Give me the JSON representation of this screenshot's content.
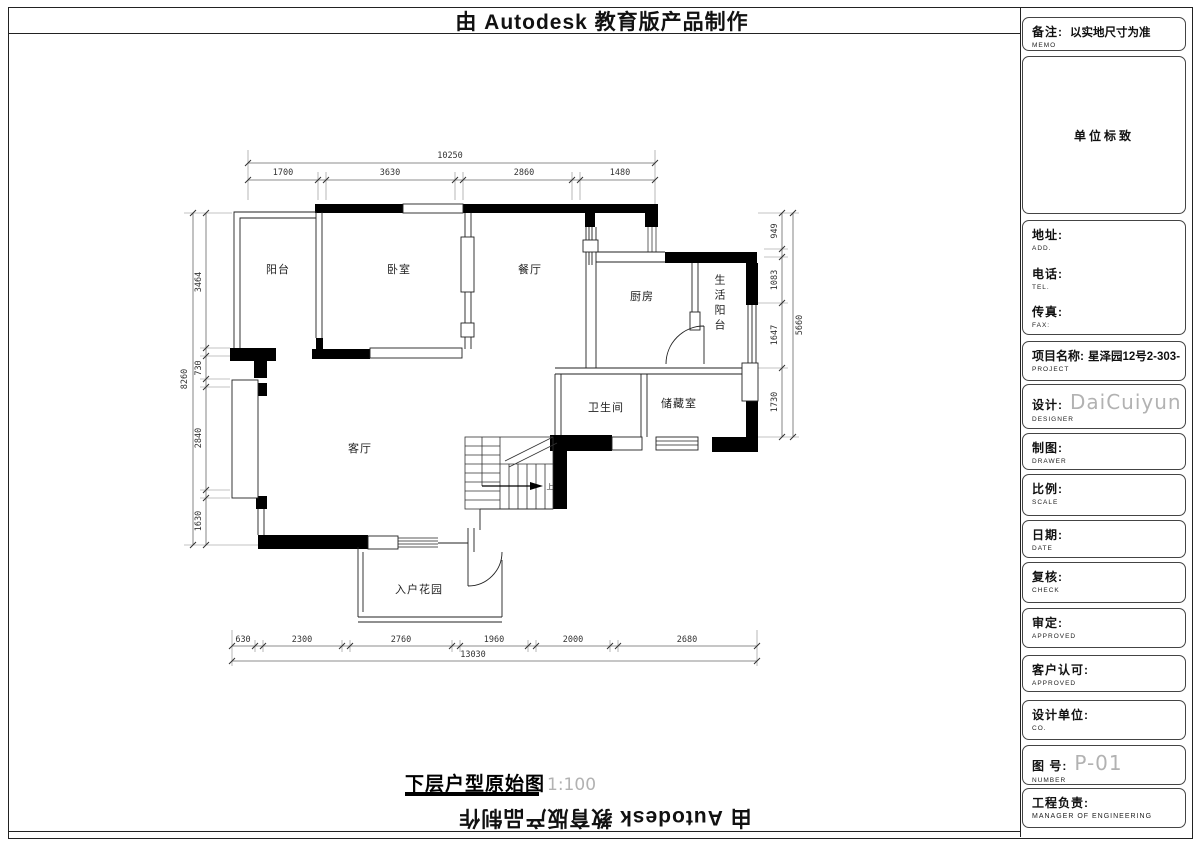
{
  "banner": {
    "text": "由 Autodesk 教育版产品制作"
  },
  "sheet_title": {
    "name": "下层户型原始图",
    "scale": "1:100"
  },
  "plan": {
    "rooms": [
      "阳台",
      "卧室",
      "餐厅",
      "厨房",
      "生活阳台",
      "卫生间",
      "储藏室",
      "客厅",
      "入户花园"
    ],
    "stair_direction": "上",
    "dims": {
      "top": {
        "overall": "10250",
        "segments": [
          "1700",
          "3630",
          "2860",
          "1480"
        ]
      },
      "bottom": {
        "overall": "13030",
        "segments": [
          "630",
          "2300",
          "2760",
          "1960",
          "2000",
          "2680"
        ]
      },
      "left": {
        "overall": "8260",
        "segments": [
          "3464",
          "730",
          "2840",
          "1630"
        ]
      },
      "right": {
        "overall": "5660",
        "segments": [
          "949",
          "1083",
          "1647",
          "1730"
        ]
      }
    }
  },
  "titleblock": {
    "memo": {
      "zh": "备注:",
      "en": "MEMO",
      "value": "以实地尺寸为准"
    },
    "logo": {
      "value": "单位标致"
    },
    "contact": {
      "address": {
        "zh": "地址:",
        "en": "ADD."
      },
      "phone": {
        "zh": "电话:",
        "en": "TEL."
      },
      "fax": {
        "zh": "传真:",
        "en": "FAX:"
      }
    },
    "project": {
      "zh": "项目名称:",
      "en": "PROJECT",
      "value": "星泽园12号2-303-"
    },
    "designer": {
      "zh": "设计:",
      "en": "DESIGNER",
      "value": "DaiCuiyun"
    },
    "drawer": {
      "zh": "制图:",
      "en": "DRAWER"
    },
    "scale": {
      "zh": "比例:",
      "en": "SCALE"
    },
    "date": {
      "zh": "日期:",
      "en": "DATE"
    },
    "check": {
      "zh": "复核:",
      "en": "CHECK"
    },
    "approved": {
      "zh": "审定:",
      "en": "APPROVED"
    },
    "client": {
      "zh": "客户认可:",
      "en": "APPROVED"
    },
    "company": {
      "zh": "设计单位:",
      "en": "CO."
    },
    "number": {
      "zh": "图  号:",
      "en": "NUMBER",
      "value": "P-01"
    },
    "engineer": {
      "zh": "工程负责:",
      "en": "MANAGER OF ENGINEERING"
    }
  },
  "colors": {
    "cad_gray": "#b2b2b2",
    "line": "#000000"
  }
}
